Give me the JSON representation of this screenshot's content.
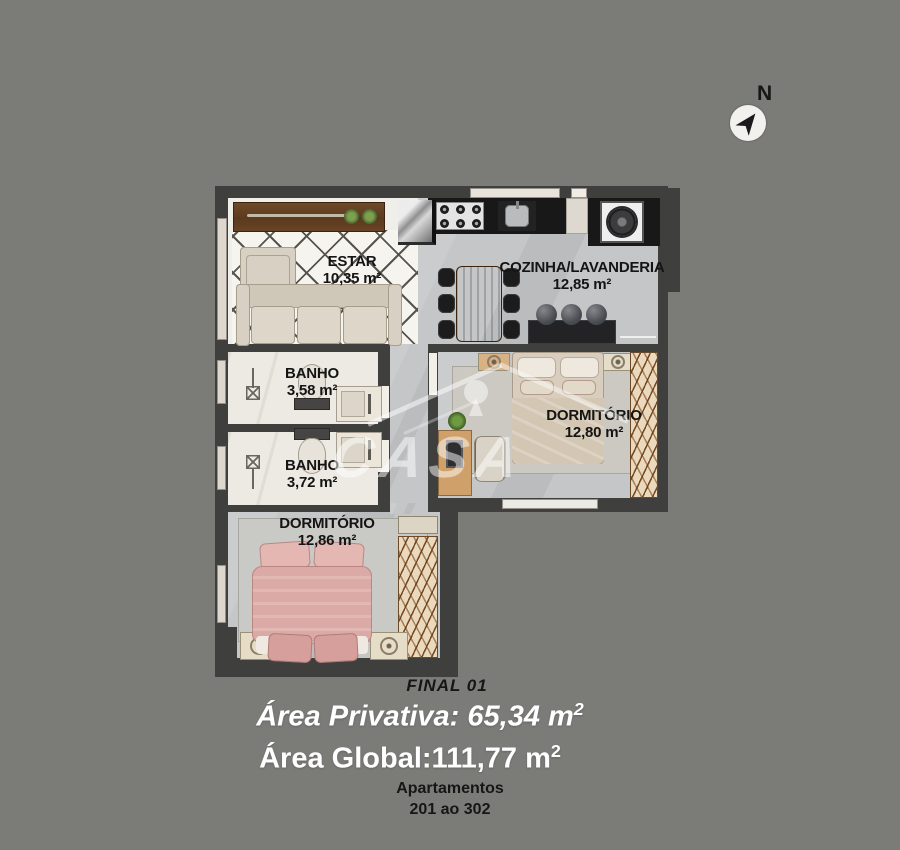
{
  "colors": {
    "background": "#7b7b78",
    "wall": "#3f3f3d",
    "floor_gray": "#c5c6c8",
    "floor_marble": "#edeae3",
    "bed_pink": "#dcaaa6",
    "wood_dark": "#6b4426",
    "counter_black": "#181818"
  },
  "compass": {
    "north_label": "N"
  },
  "watermark": {
    "text": "CASA"
  },
  "rooms": {
    "estar": {
      "name": "ESTAR",
      "area": "10,35 m²"
    },
    "cozinha": {
      "name": "COZINHA/LAVANDERIA",
      "area": "12,85 m²"
    },
    "banho_1": {
      "name": "BANHO",
      "area": "3,58 m²"
    },
    "banho_2": {
      "name": "BANHO",
      "area": "3,72 m²"
    },
    "dormitorio_1": {
      "name": "DORMITÓRIO",
      "area": "12,80 m²"
    },
    "dormitorio_2": {
      "name": "DORMITÓRIO",
      "area": "12,86 m²"
    }
  },
  "footer": {
    "final": "FINAL 01",
    "area_privativa": "Área Privativa: 65,34 m",
    "area_global": "Área Global:111,77 m",
    "sup2": "2",
    "apartamentos": "Apartamentos",
    "range": "201 ao 302"
  }
}
